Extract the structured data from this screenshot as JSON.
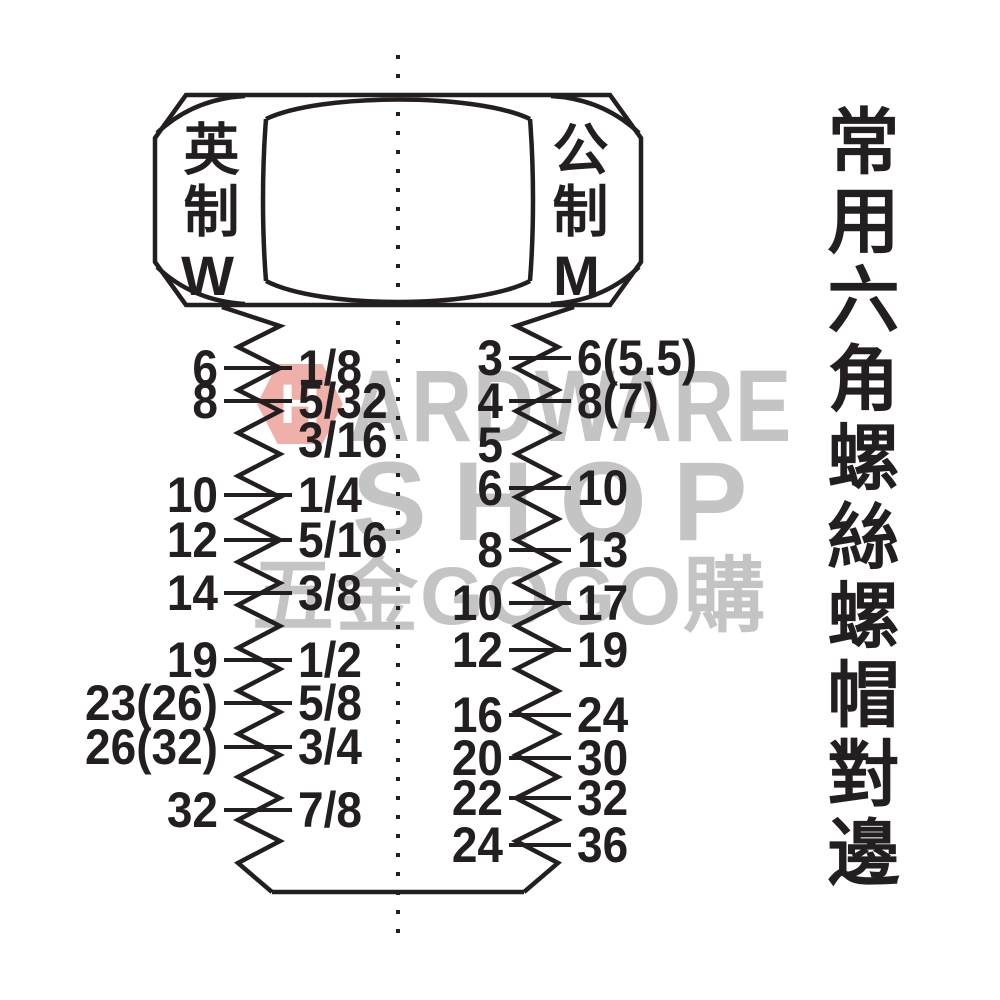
{
  "colors": {
    "ink": "#231f20",
    "watermark_gray": "#c4c4c4",
    "watermark_pink": "#f0b0aa",
    "watermark_letter_white": "#ffffff",
    "background": "#ffffff"
  },
  "side_title": "常用六角螺絲螺帽對邊",
  "bolt_head": {
    "left_face_label": "英制W",
    "right_face_label": "公制M"
  },
  "watermark": {
    "hex_letter": "H",
    "line1_rest": "ARDWARE",
    "line2": "SHOP",
    "line3": "五金GOGO購"
  },
  "chart_data": {
    "type": "table",
    "title": "常用六角螺絲螺帽對邊",
    "imperial_column": {
      "face_label": "英制W",
      "rows": [
        {
          "af_mm": "6",
          "size": "1/8"
        },
        {
          "af_mm": "8",
          "size": "5/32"
        },
        {
          "af_mm": "",
          "size": "3/16"
        },
        {
          "af_mm": "10",
          "size": "1/4"
        },
        {
          "af_mm": "12",
          "size": "5/16"
        },
        {
          "af_mm": "14",
          "size": "3/8"
        },
        {
          "af_mm": "19",
          "size": "1/2"
        },
        {
          "af_mm": "23(26)",
          "size": "5/8"
        },
        {
          "af_mm": "26(32)",
          "size": "3/4"
        },
        {
          "af_mm": "32",
          "size": "7/8"
        }
      ]
    },
    "metric_column": {
      "face_label": "公制M",
      "rows": [
        {
          "size": "3",
          "af_mm": "6(5.5)"
        },
        {
          "size": "4",
          "af_mm": "8(7)"
        },
        {
          "size": "5",
          "af_mm": ""
        },
        {
          "size": "6",
          "af_mm": "10"
        },
        {
          "size": "8",
          "af_mm": "13"
        },
        {
          "size": "10",
          "af_mm": "17"
        },
        {
          "size": "12",
          "af_mm": "19"
        },
        {
          "size": "16",
          "af_mm": "24"
        },
        {
          "size": "20",
          "af_mm": "30"
        },
        {
          "size": "22",
          "af_mm": "32"
        },
        {
          "size": "24",
          "af_mm": "36"
        }
      ]
    }
  }
}
